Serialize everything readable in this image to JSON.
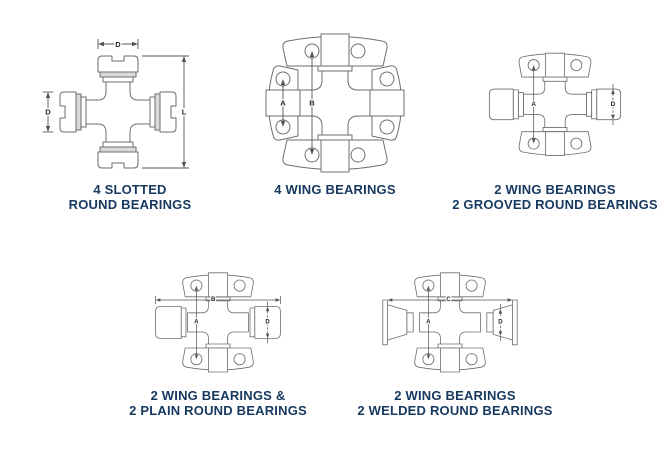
{
  "figures": [
    {
      "name": "4 slotted round bearings",
      "caption": [
        "4 SLOTTED",
        "ROUND BEARINGS"
      ],
      "dims": [
        "D",
        "D",
        "L"
      ]
    },
    {
      "name": "4 wing bearings",
      "caption": [
        "4 WING BEARINGS"
      ],
      "dims": [
        "A",
        "B"
      ]
    },
    {
      "name": "2 wing bearings 2 grooved round bearings",
      "caption": [
        "2 WING BEARINGS",
        "2 GROOVED ROUND BEARINGS"
      ],
      "dims": [
        "A",
        "D"
      ]
    },
    {
      "name": "2 wing bearings and 2 plain round bearings",
      "caption": [
        "2 WING BEARINGS &",
        "2 PLAIN ROUND BEARINGS"
      ],
      "dims": [
        "B",
        "A",
        "D"
      ]
    },
    {
      "name": "2 wing bearings 2 welded round bearings",
      "caption": [
        "2 WING BEARINGS",
        "2 WELDED ROUND BEARINGS"
      ],
      "dims": [
        "C",
        "A",
        "D"
      ]
    }
  ],
  "colors": {
    "caption": "#17395F",
    "line": "#6E6E6E",
    "dim": "#555555",
    "dim_text": "#222222",
    "cap_fill": "#DBDBDB",
    "background": "#FFFFFF"
  }
}
